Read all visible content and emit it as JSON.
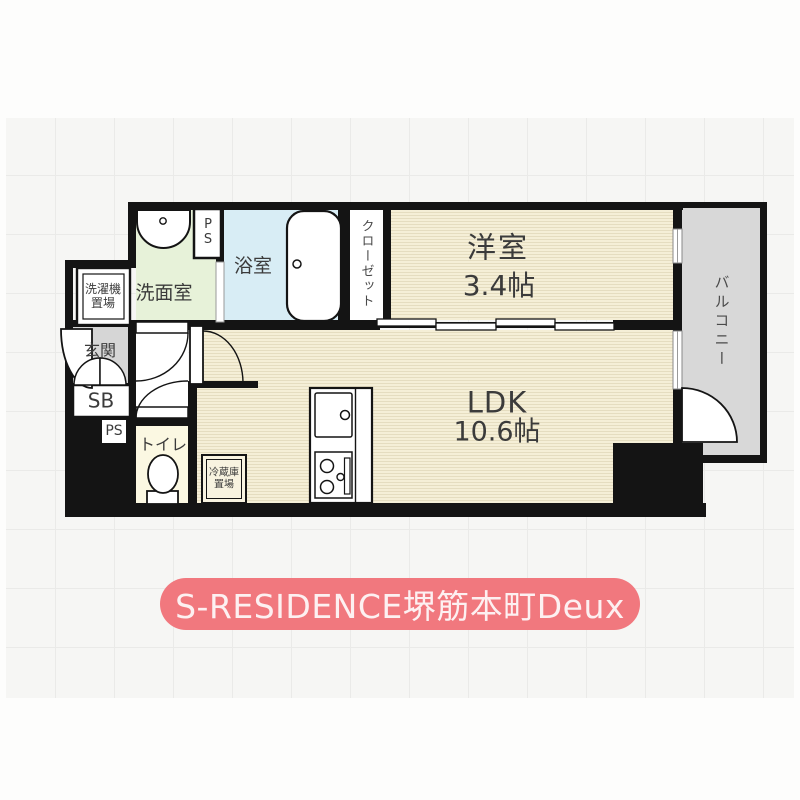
{
  "banner": {
    "title": "S-RESIDENCE堺筋本町Deux"
  },
  "rooms": {
    "washroom": "洗面室",
    "bathroom": "浴室",
    "closet": "クローゼット",
    "western_room": "洋室",
    "western_room_size": "3.4帖",
    "ldk": "LDK",
    "ldk_size": "10.6帖",
    "balcony": "バルコニー",
    "entrance": "玄関",
    "toilet": "トイレ",
    "shoe_box": "SB",
    "pipe_space_top": "PS",
    "pipe_space_bottom": "PS",
    "laundry_area": "洗濯機置場",
    "fridge_area": "冷蔵庫置場"
  },
  "colors": {
    "wall": "#141414",
    "floor_cream": "#f5efd7",
    "floor_stripe": "#e5ddc0",
    "washroom_green": "#e7f2d9",
    "bath_blue": "#d8edf5",
    "toilet_yellow": "#fbf8e2",
    "balcony_gray": "#d8d8d8",
    "entrance_gray": "#d6d6d6",
    "banner_pink": "#f1787e"
  }
}
